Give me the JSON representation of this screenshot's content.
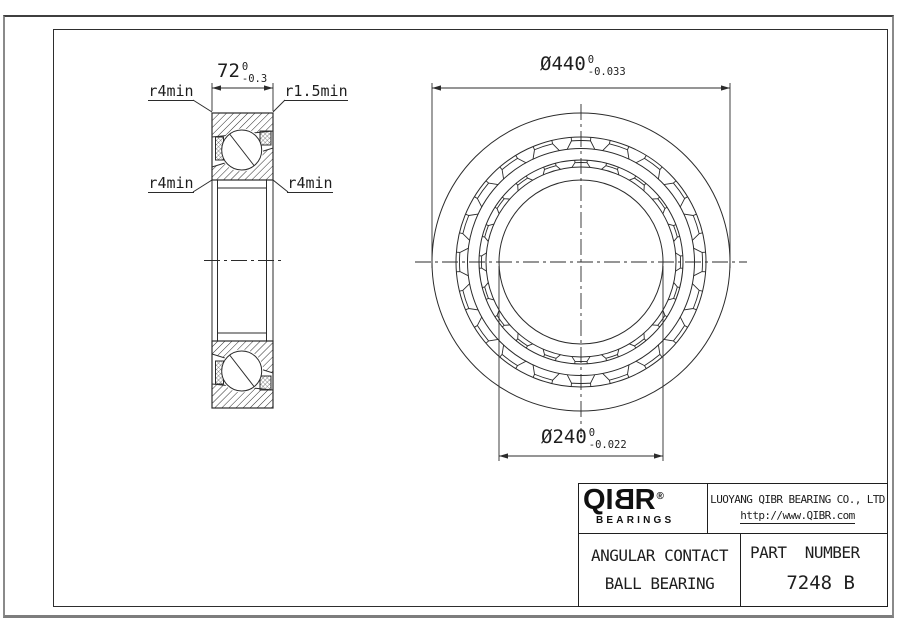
{
  "title_block": {
    "logo": {
      "part1": "QI",
      "part2": "B",
      "part3": "R",
      "registered": "®",
      "sub": "BEARINGS"
    },
    "company": "LUOYANG QIBR BEARING CO., LTD",
    "website": "http://www.QIBR.com",
    "product_line1": "ANGULAR CONTACT",
    "product_line2": "BALL BEARING",
    "part_number_label": "PART  NUMBER",
    "part_number": "7248 B"
  },
  "dimensions": {
    "width": {
      "value": "72",
      "tol_upper": "0",
      "tol_lower": "-0.3"
    },
    "outer_diameter": {
      "value": "Ø440",
      "tol_upper": "0",
      "tol_lower": "-0.033"
    },
    "bore_diameter": {
      "value": "Ø240",
      "tol_upper": "0",
      "tol_lower": "-0.022"
    },
    "radius_labels": {
      "top_left": "r4min",
      "top_right": "r1.5min",
      "bottom_left": "r4min",
      "bottom_right": "r4min"
    }
  },
  "drawing": {
    "line_color": "#2b2b2b",
    "front": {
      "cx": 581,
      "cy": 262,
      "radii": [
        149,
        125,
        113.5,
        102,
        95,
        82
      ],
      "bands": [
        {
          "rOut": 125,
          "rP": 121.5,
          "rIn": 113.5,
          "ha": 4.5,
          "hs": 7,
          "n": 20
        },
        {
          "rOut": 102,
          "rP": 99.5,
          "rIn": 95,
          "ha": 3.5,
          "hs": 5.5,
          "n": 20
        }
      ]
    },
    "section": {
      "rectTop": [
        212,
        113,
        61,
        67
      ],
      "rectBot": [
        212,
        341,
        61,
        67
      ],
      "outerTop": "212,113 273,113 273,131 212,137",
      "innerTop": "212,167 273,148 273,180 212,180",
      "innerBot": "212,341 273,341 273,373 212,354",
      "outerBot": "212,384 273,390 273,408 212,408",
      "balls": [
        {
          "x": 241.7,
          "y": 150,
          "r": 20,
          "carve": 21.5,
          "line": [
            230,
            134.5,
            254,
            165.5
          ]
        },
        {
          "x": 241.7,
          "y": 371,
          "r": 20,
          "carve": 21.5,
          "line": [
            230,
            355.5,
            254,
            386.5
          ]
        }
      ],
      "cages": [
        [
          215.5,
          137,
          8,
          23
        ],
        [
          260,
          131,
          11,
          14
        ],
        [
          215.5,
          361,
          8,
          23
        ],
        [
          260,
          376,
          11,
          14
        ]
      ],
      "bores": [
        [
          212,
          180,
          212,
          341
        ],
        [
          217.5,
          180,
          217.5,
          341
        ],
        [
          266.5,
          180,
          266.5,
          341
        ],
        [
          273,
          180,
          273,
          341
        ],
        [
          217.5,
          188,
          266.5,
          188
        ],
        [
          217.5,
          333,
          266.5,
          333
        ]
      ]
    },
    "dims": [
      {
        "ext": [
          [
            212,
            83,
            212,
            111
          ],
          [
            273,
            83,
            273,
            111
          ]
        ],
        "line": [
          212,
          88,
          273,
          88
        ]
      },
      {
        "ext": [
          [
            432,
            83,
            432,
            268
          ],
          [
            730,
            83,
            730,
            268
          ]
        ],
        "line": [
          432,
          88,
          730,
          88
        ]
      },
      {
        "ext": [
          [
            499,
            266,
            499,
            461
          ],
          [
            663,
            266,
            663,
            461
          ]
        ],
        "line": [
          499,
          456,
          663,
          456
        ]
      }
    ],
    "centerlines": [
      [
        415,
        262,
        747,
        262
      ],
      [
        581,
        104,
        581,
        434
      ],
      [
        204,
        260.5,
        281,
        260.5
      ]
    ],
    "leaders": [
      [
        193,
        100,
        212,
        112
      ],
      [
        285,
        100,
        273,
        112
      ],
      [
        193,
        192,
        212,
        180
      ],
      [
        288,
        192,
        273,
        180
      ]
    ]
  }
}
